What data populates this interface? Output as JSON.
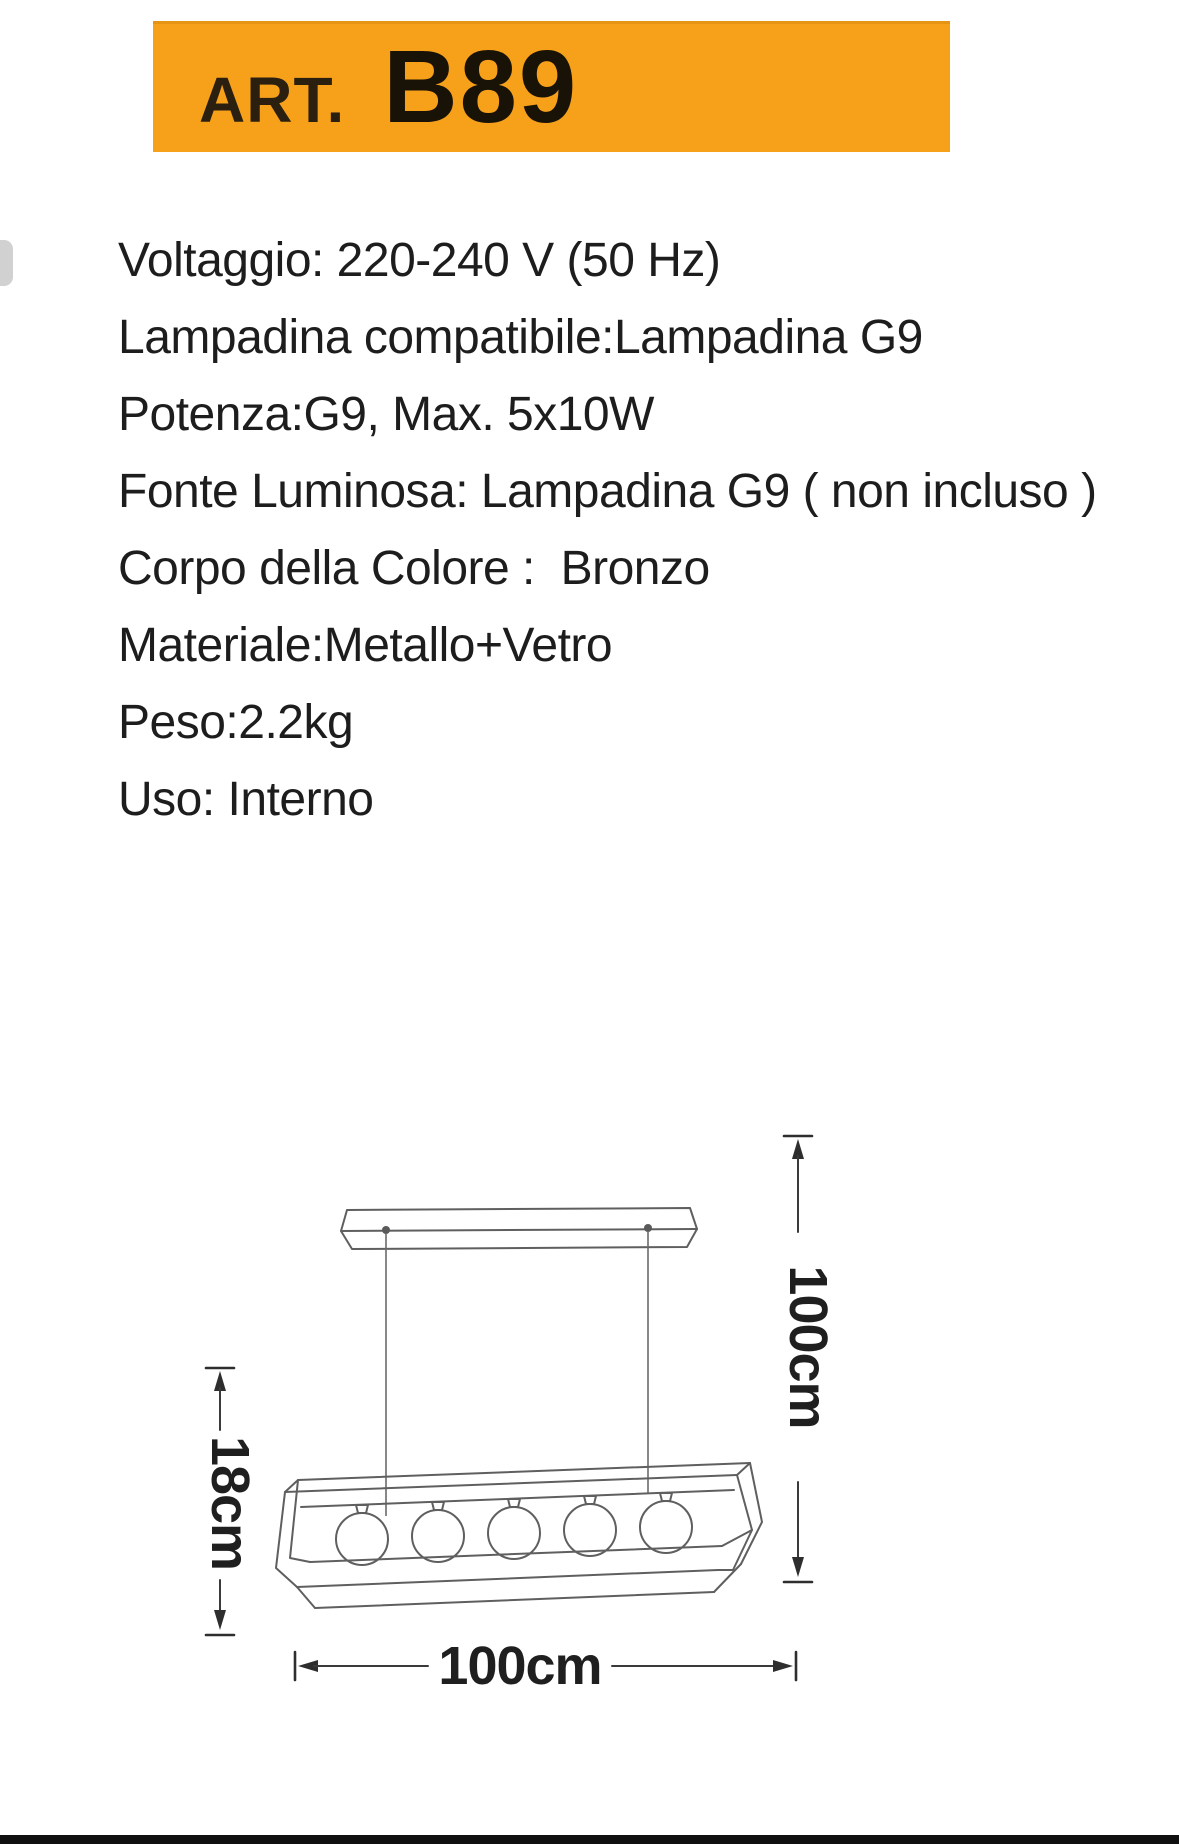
{
  "header": {
    "art_label": "ART.",
    "model": "B89",
    "banner_color": "#F7A11B"
  },
  "specs": {
    "lines": [
      "Voltaggio: 220-240 V (50 Hz)",
      "Lampadina compatibile:Lampadina G9",
      "Potenza:G9, Max. 5x10W",
      "Fonte Luminosa: Lampadina G9 ( non incluso )",
      "Corpo della Colore :  Bronzo",
      "Materiale:Metallo+Vetro",
      "Peso:2.2kg",
      "Uso: Interno"
    ]
  },
  "diagram": {
    "type": "technical-dimension-drawing",
    "subject": "linear pendant lamp with 5 glass globes",
    "bulb_count": 5,
    "total_height_label": "100cm",
    "fixture_height_label": "18cm",
    "width_label": "100cm",
    "line_color": "#5f5f5f",
    "dimension_color": "#3a3a3a",
    "label_color": "#1f1f1f"
  },
  "footer": {
    "bar_color": "#101010"
  }
}
